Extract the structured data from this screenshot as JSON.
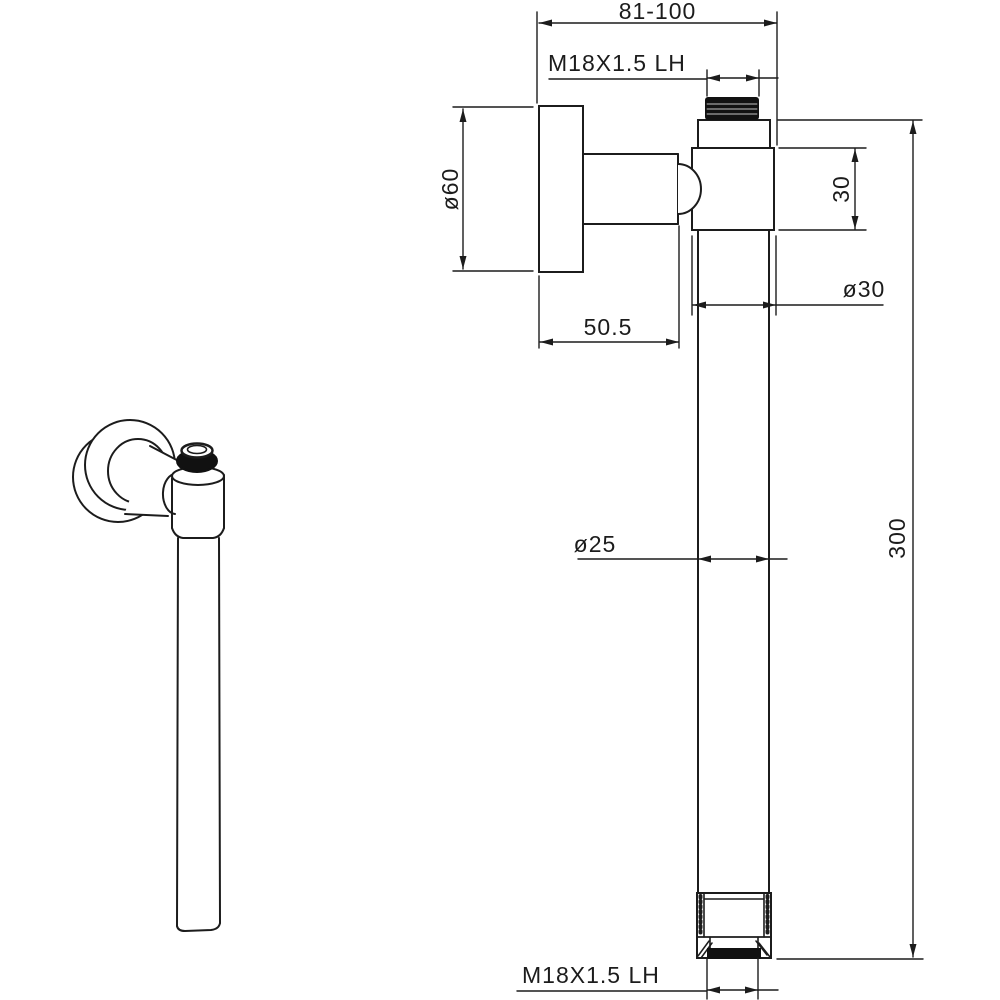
{
  "drawing": {
    "kind": "technical-dimension-drawing",
    "colors": {
      "line": "#1c1c1c",
      "background": "#ffffff",
      "thread_fill": "#111111"
    },
    "dimensions": {
      "width_range": "81-100",
      "thread_top": "M18X1.5 LH",
      "flange_diameter": "ø60",
      "valve_height": "30",
      "valve_diameter": "ø30",
      "flange_depth": "50.5",
      "pipe_diameter": "ø25",
      "pipe_length": "300",
      "thread_bottom": "M18X1.5 LH"
    }
  }
}
